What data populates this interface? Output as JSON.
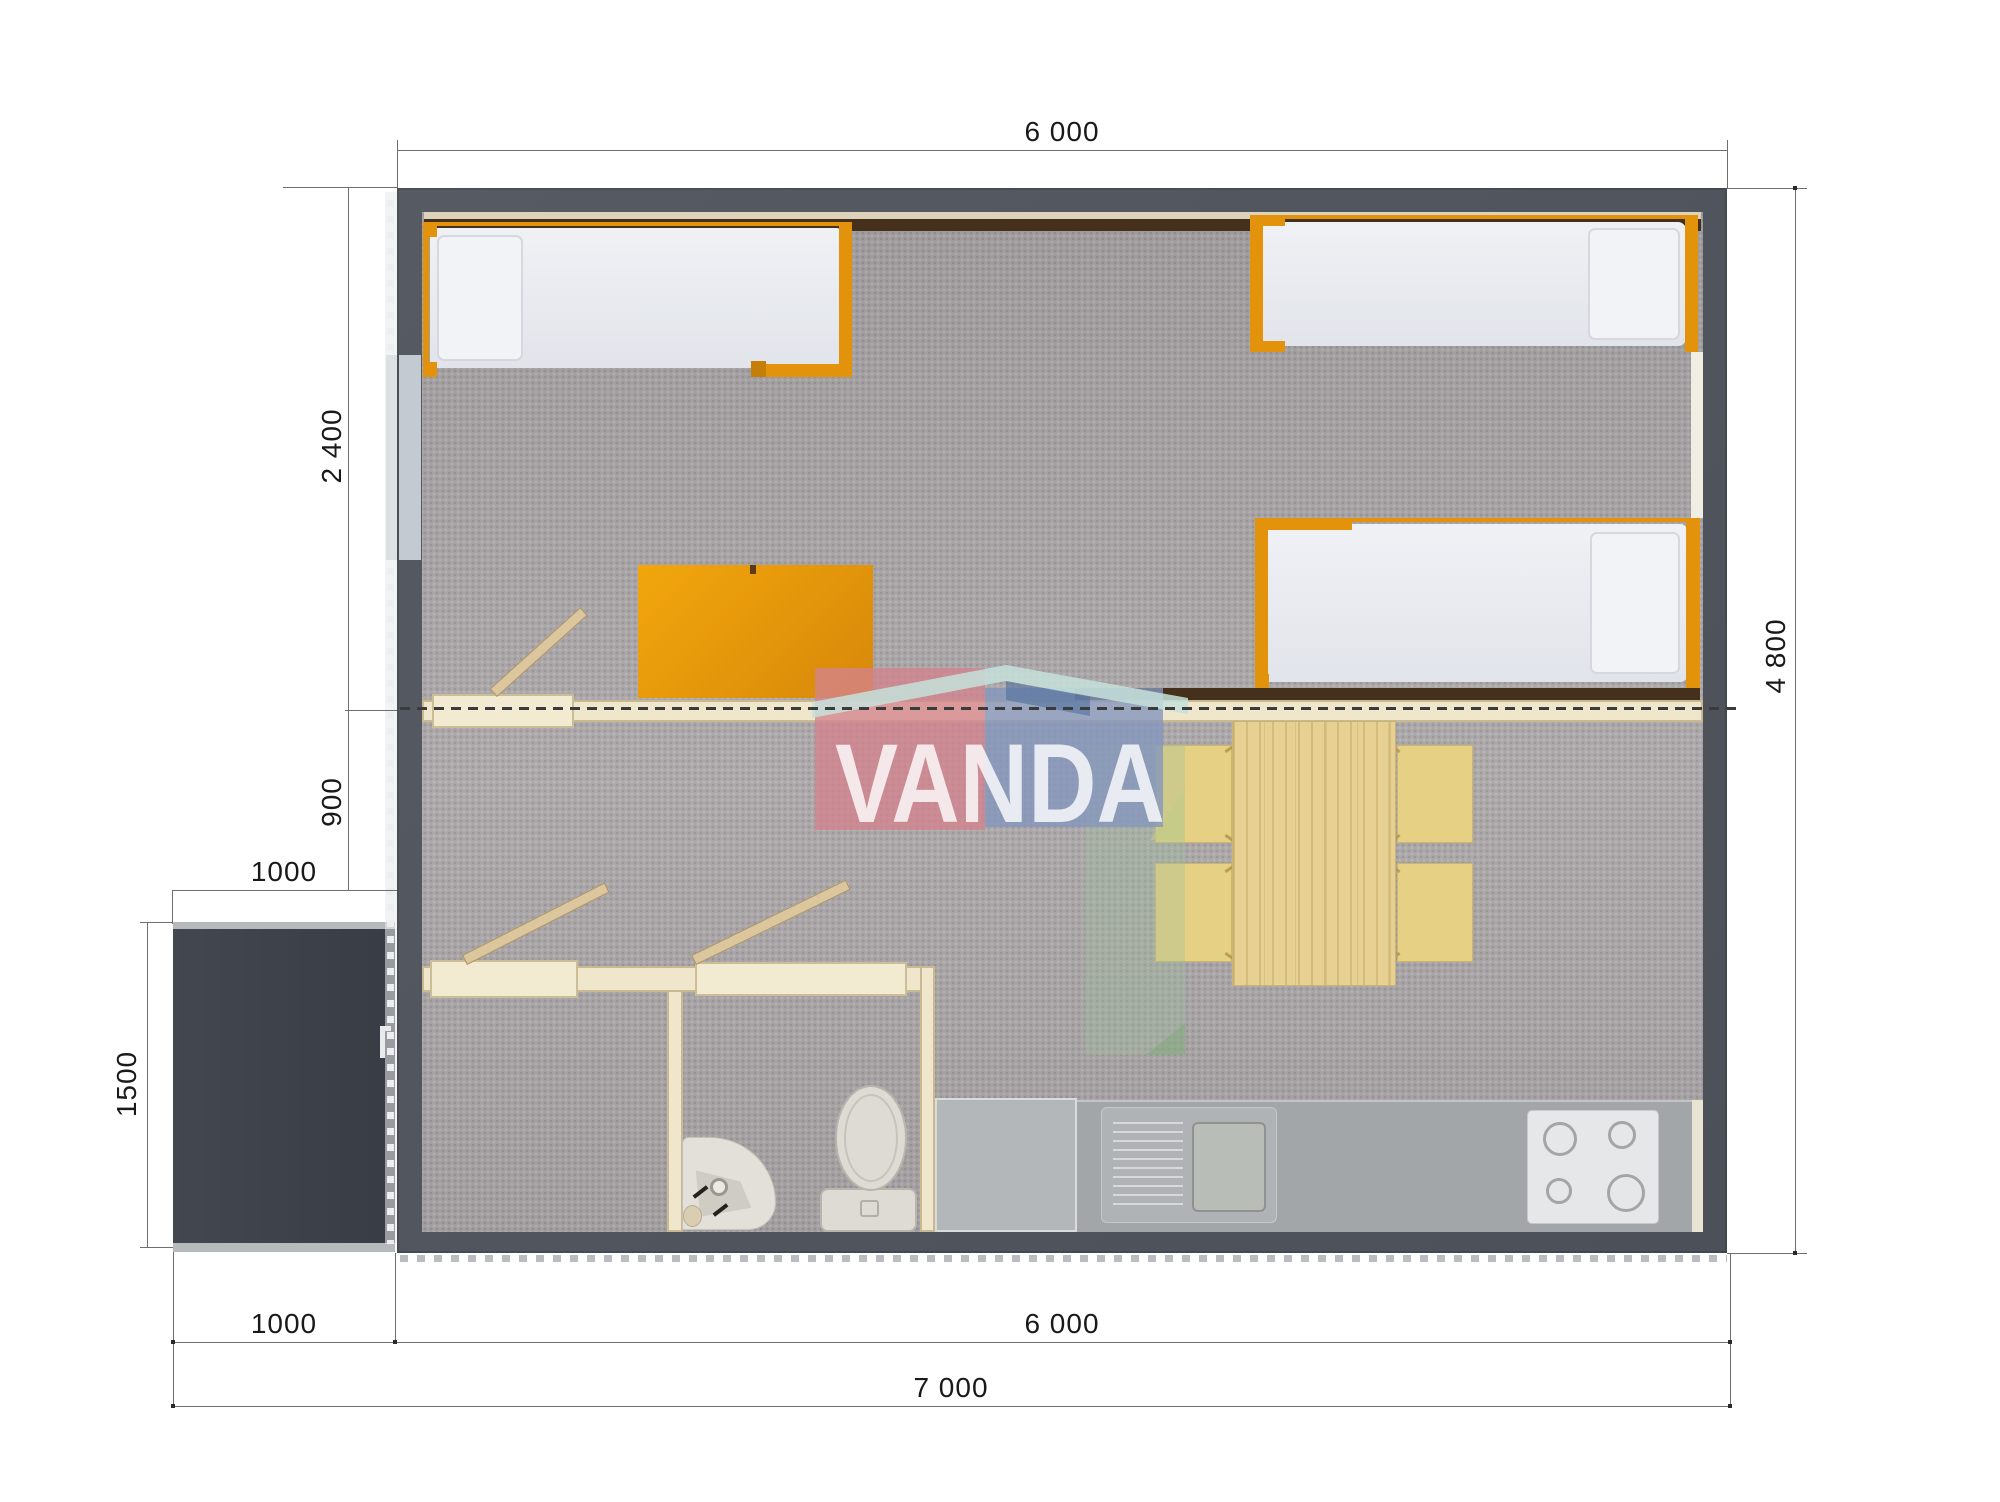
{
  "watermark": {
    "text": "VANDA",
    "pink_block": "#d4838d",
    "blue_block": "#8496bd",
    "roof": "#c6e0da",
    "green_block": "#9fbf9b"
  },
  "dimensions": {
    "top_width": "6 000",
    "bedroom_depth": "2 400",
    "hall_depth": "900",
    "porch_width_top": "1000",
    "porch_depth": "1500",
    "bottom_porch": "1000",
    "bottom_module": "6 000",
    "bottom_total": "7 000",
    "right_depth": "4 800"
  },
  "palette": {
    "exterior_wall": "#53575f",
    "porch": "#3f434b",
    "carpet_floor": "#a9a5a7",
    "interior_partition": "#efe6cb",
    "accent_orange": "#e2930b",
    "kitchen_counter": "#a3a6a8",
    "wood_table": "#e6d193",
    "chair": "#e5d083",
    "mattress": "#edeff3",
    "window_band_brown": "#45301b"
  },
  "furniture": {
    "beds": [
      "single-bed-top-left",
      "single-bed-top-right",
      "single-bed-middle-right"
    ],
    "desk": "orange-desk",
    "dining": [
      "dining-table",
      "chair x4"
    ],
    "kitchen": [
      "kitchen-counter",
      "kitchen-sink-with-drainboard",
      "cooktop-4-burners"
    ],
    "bathroom": [
      "corner-washbasin",
      "toilet"
    ],
    "doors": [
      "bedroom-door-open",
      "bathroom-door-open-left",
      "bathroom-door-open-right",
      "entry-door"
    ]
  }
}
